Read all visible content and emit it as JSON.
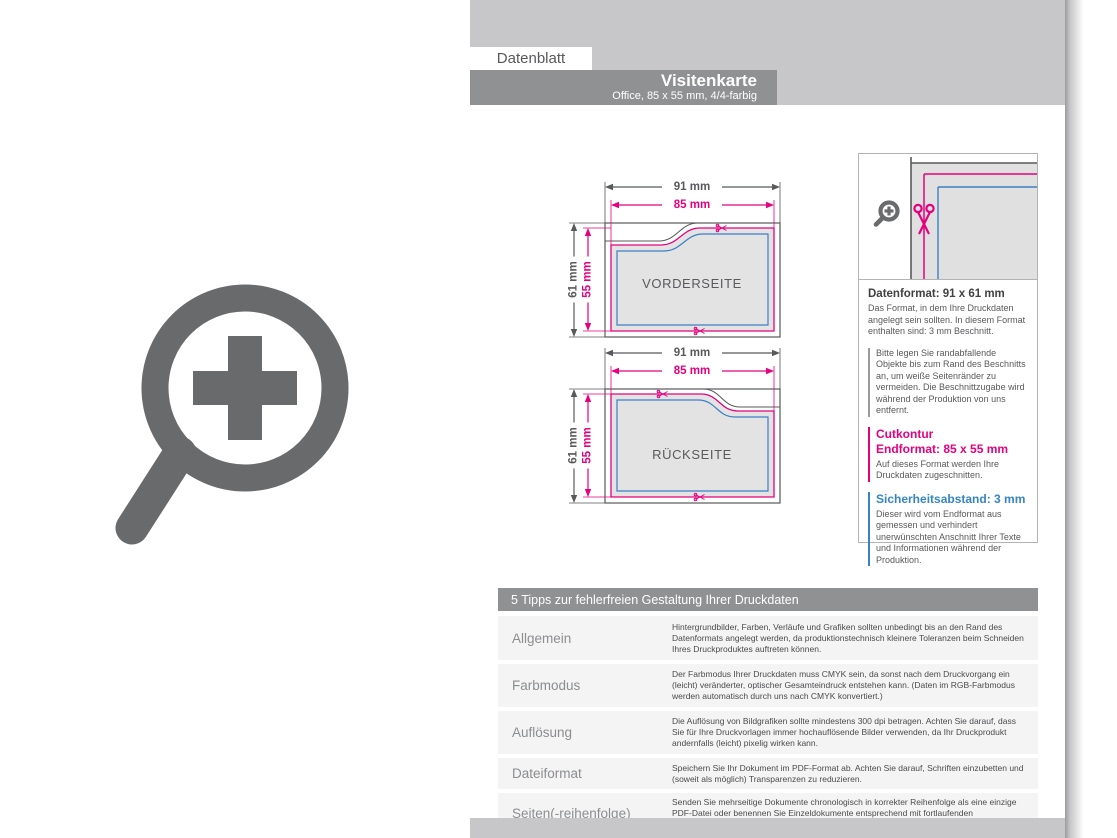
{
  "header": {
    "tab": "Datenblatt",
    "title": "Visitenkarte",
    "subtitle": "Office, 85 x 55 mm, 4/4-farbig"
  },
  "diagrams": {
    "front": {
      "label": "VORDERSEITE",
      "dim_outer_w": "91 mm",
      "dim_inner_w": "85 mm",
      "dim_outer_h": "61 mm",
      "dim_inner_h": "55 mm"
    },
    "back": {
      "label": "RÜCKSEITE",
      "dim_outer_w": "91 mm",
      "dim_inner_w": "85 mm",
      "dim_outer_h": "61 mm",
      "dim_inner_h": "55 mm"
    }
  },
  "info_panel": {
    "datenformat_title": "Datenformat: 91 x 61 mm",
    "datenformat_text": "Das Format, in dem Ihre Druckdaten angelegt sein sollten. In diesem Format enthalten sind: 3 mm Beschnitt.",
    "bleed_note": "Bitte legen Sie randabfallende Objekte bis zum Rand des Beschnitts an, um weiße Seitenränder zu vermeiden. Die Beschnittzugabe wird während der Produktion von uns entfernt.",
    "cutkontur_title": "Cutkontur",
    "endformat_title": "Endformat: 85 x 55 mm",
    "endformat_text": "Auf dieses Format werden Ihre Druckdaten zugeschnitten.",
    "sicherheit_title": "Sicherheitsabstand: 3 mm",
    "sicherheit_text": "Dieser wird vom Endformat aus gemessen und verhindert unerwünschten Anschnitt Ihrer Texte und Informationen während der Produktion."
  },
  "tips": {
    "title": "5 Tipps zur fehlerfreien Gestaltung Ihrer Druckdaten",
    "rows": [
      {
        "label": "Allgemein",
        "text": "Hintergrundbilder, Farben, Verläufe und Grafiken sollten unbedingt bis an den Rand des Datenformats angelegt werden, da produktionstechnisch kleinere Toleranzen beim Schneiden Ihres Druckproduktes auftreten können."
      },
      {
        "label": "Farbmodus",
        "text": "Der Farbmodus Ihrer Druckdaten muss CMYK sein, da sonst nach dem Druckvorgang ein (leicht) veränderter, optischer Gesamteindruck entstehen kann. (Daten im RGB-Farbmodus werden automatisch durch uns nach CMYK konvertiert.)"
      },
      {
        "label": "Auflösung",
        "text": "Die Auflösung von Bildgrafiken sollte mindestens 300 dpi betragen. Achten Sie darauf, dass Sie für Ihre Druckvorlagen immer hochauflösende Bilder verwenden, da Ihr Druckprodukt andernfalls (leicht) pixelig wirken kann."
      },
      {
        "label": "Dateiformat",
        "text": "Speichern Sie Ihr Dokument im PDF-Format ab. Achten Sie darauf, Schriften einzubetten und (soweit als möglich) Transparenzen zu reduzieren."
      },
      {
        "label": "Seiten(-reihenfolge)",
        "text": "Senden Sie mehrseitige Dokumente chronologisch in korrekter Reihenfolge als eine einzige PDF-Datei oder benennen Sie Einzeldokumente entsprechend mit fortlaufenden Seitennummern."
      }
    ]
  },
  "colors": {
    "magenta": "#e5007d",
    "blue": "#3585c5",
    "dark_gray": "#58595b",
    "band_gray": "#c7c7c9",
    "bar_gray": "#8f9193",
    "card_fill": "#e3e3e4"
  }
}
